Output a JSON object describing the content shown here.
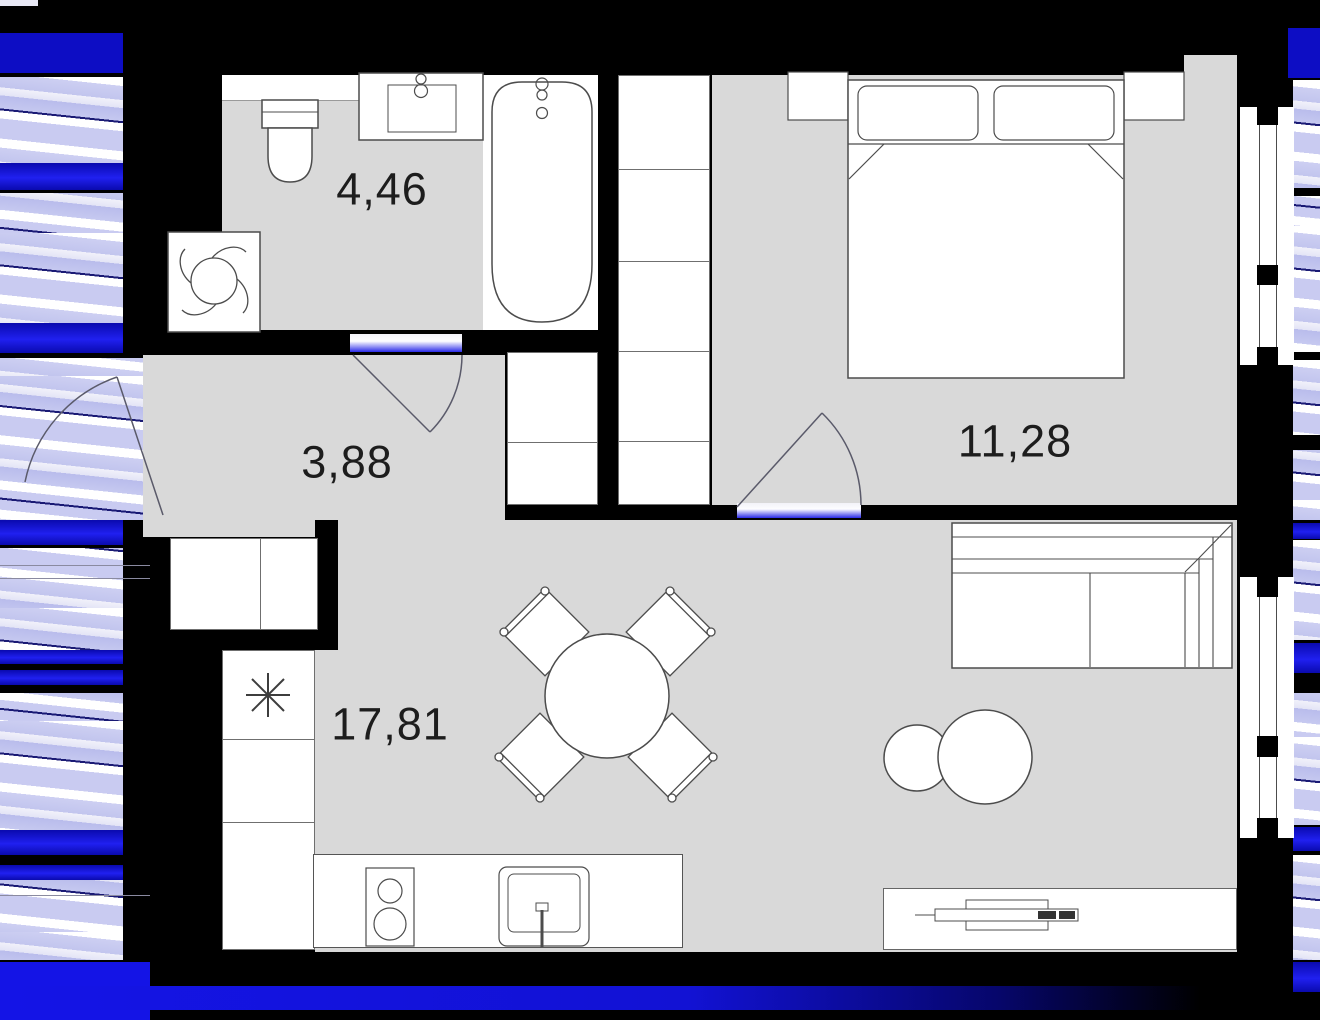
{
  "title": "apartment floor plan with glitch corruption",
  "rooms": {
    "bathroom": {
      "label": "4,46"
    },
    "hallway": {
      "label": "3,88"
    },
    "bedroom": {
      "label": "11,28"
    },
    "living": {
      "label": "17,81"
    }
  },
  "colors": {
    "floor": "#d9d9d9",
    "wall": "#000000",
    "furniture_line": "#4c4c4c",
    "furniture_fill": "#ffffff",
    "glitch_blue": "#1414e6",
    "glitch_lavender": "#c9cbf1",
    "glitch_white": "#ffffff"
  },
  "icons": {
    "fridge": "snowflake-icon",
    "washing_machine": "fan-icon",
    "bathtub": "faucet-icon",
    "bathroom_sink": "faucet-icon",
    "kitchen_sink": "tap-icon",
    "tv": "tv-top-view-icon"
  }
}
